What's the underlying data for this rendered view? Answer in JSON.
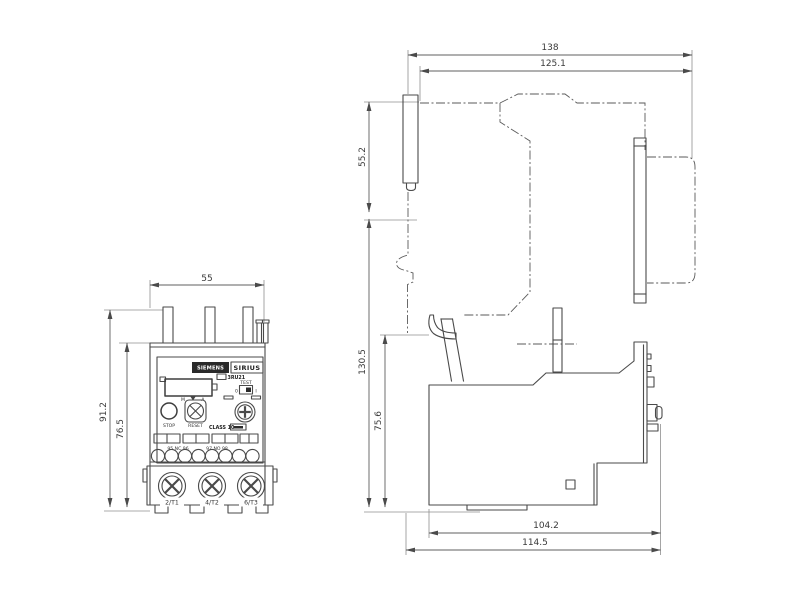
{
  "front_view": {
    "dim_width": "55",
    "dim_height_total": "91.2",
    "dim_height_body": "76.5",
    "brand": "SIEMENS",
    "series": "SIRIUS",
    "model": "3RU21",
    "test_label": "TEST",
    "test_off": "0",
    "test_on": "I",
    "stop_label": "STOP",
    "reset_label": "RESET",
    "class_label": "CLASS 10",
    "dial_min": "M",
    "dial_max": "A",
    "aux_nc": "95 NC 96",
    "aux_no": "97 NO 98",
    "terminals": [
      "2/T1",
      "4/T2",
      "6/T3"
    ]
  },
  "side_view": {
    "dim_depth_total": "138",
    "dim_depth_upper": "125.1",
    "dim_height_upper": "55.2",
    "dim_height_total": "130.5",
    "dim_height_lower": "75.6",
    "dim_depth_body": "104.2",
    "dim_depth_base": "114.5"
  }
}
